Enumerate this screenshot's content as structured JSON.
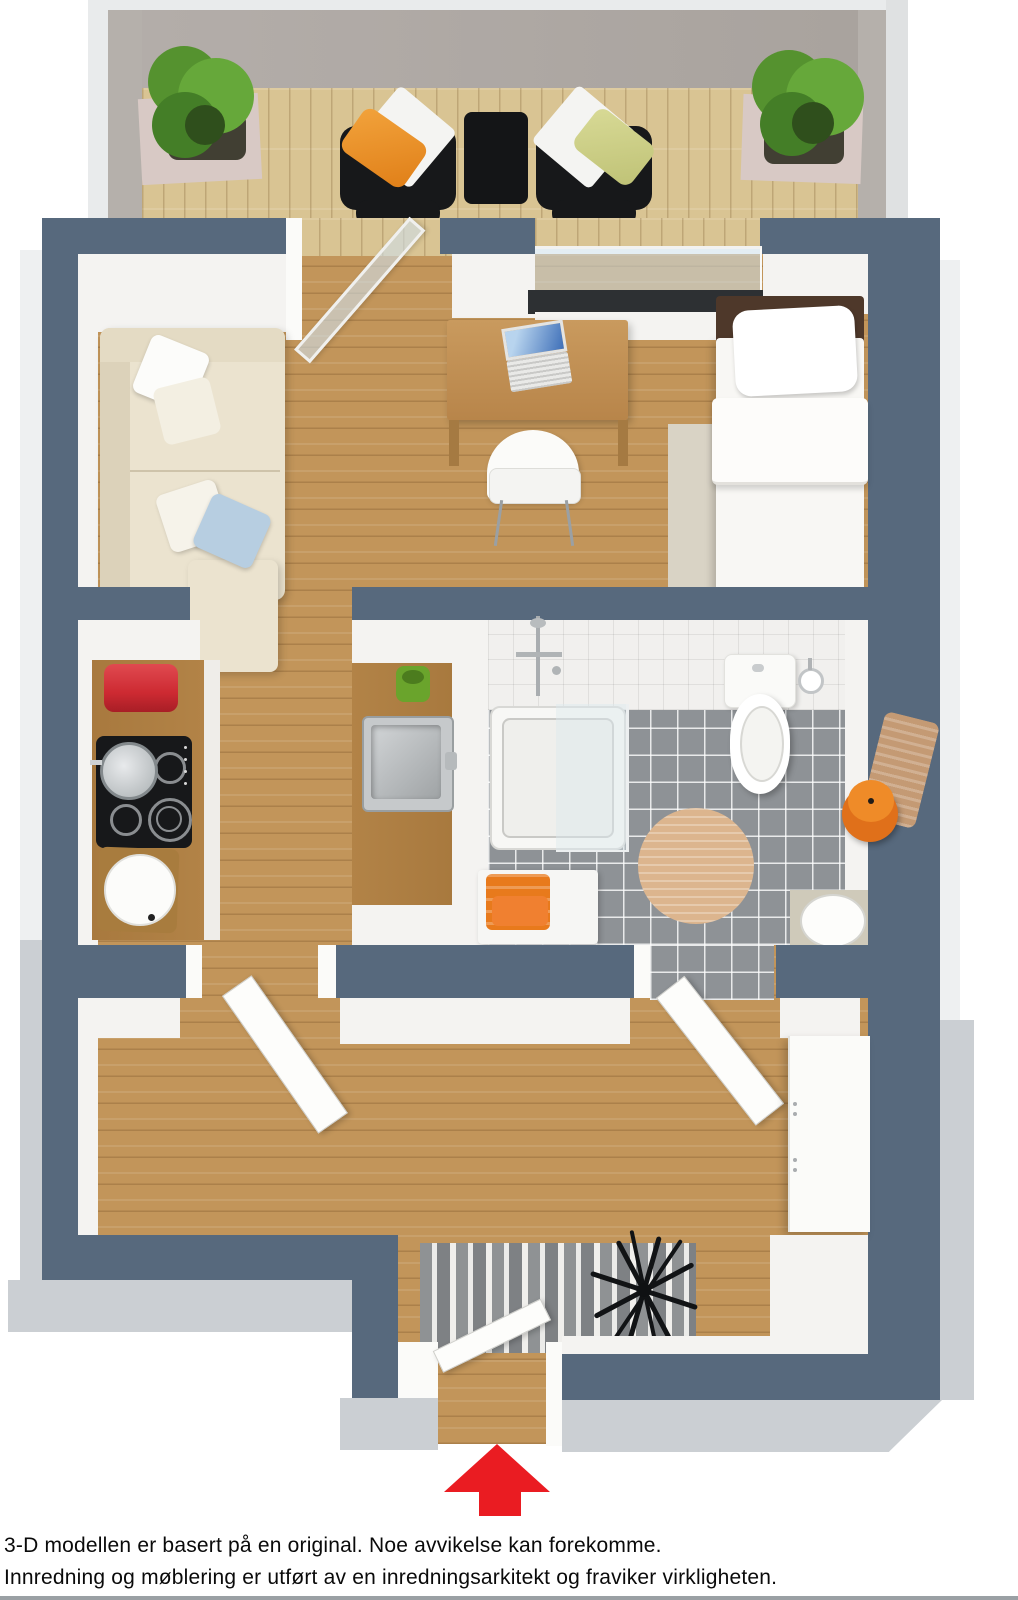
{
  "image_type": "3d-floor-plan-rendering",
  "caption": {
    "line1": "3-D modellen er basert på en original. Noe avvikelse kan forekomme.",
    "line2": "Innredning og møblering er utført av en inredningsarkitekt og fraviker virkligheten."
  },
  "entrance_arrow": {
    "direction": "up",
    "color": "#ea1c22"
  },
  "colors": {
    "wall_dark": "#57697d",
    "wall_inner": "#f4f3f1",
    "wall_outer": "#cbcfd3",
    "balcony_wall": "#a8a29d",
    "floor_oak": "#c2955a",
    "floor_deck": "#d9c493",
    "tile_floor": "#8e9296",
    "sofa_cream": "#ebe3cf",
    "desk_wood": "#c08c52",
    "counter_wood": "#b28347",
    "bed_brown": "#4e382a",
    "rug_beige": "#d9d3c5",
    "rug_bath": "#dcb58e",
    "accent_orange": "#e87a1c",
    "arrow_red": "#ea1c22",
    "canister_red": "#cd2a32",
    "cup_green": "#6aa42c",
    "plant_green": "#55922f",
    "laptop_screen_blue": "#3e6fb8",
    "chrome": "#b9bcbe"
  },
  "rooms": {
    "balcony": [
      "plant-left",
      "lounge-chair-left",
      "side-table",
      "lounge-chair-right",
      "plant-right"
    ],
    "living_room": [
      "sofa",
      "desk",
      "laptop",
      "desk-chair",
      "bed",
      "rug",
      "window",
      "balcony-door"
    ],
    "kitchen": [
      "counter-left",
      "canister",
      "cooktop",
      "pot",
      "stool",
      "peninsula-counter",
      "cup",
      "sink"
    ],
    "bathroom": [
      "shower",
      "toilet",
      "toilet-paper-holder",
      "round-rug",
      "stool-orange",
      "towel",
      "bench",
      "towels",
      "vanity-sink"
    ],
    "hallway": [
      "wardrobe",
      "door-kitchen",
      "door-bathroom"
    ],
    "entrance": [
      "striped-rug",
      "coat-rack",
      "entry-door",
      "direction-arrow"
    ]
  }
}
